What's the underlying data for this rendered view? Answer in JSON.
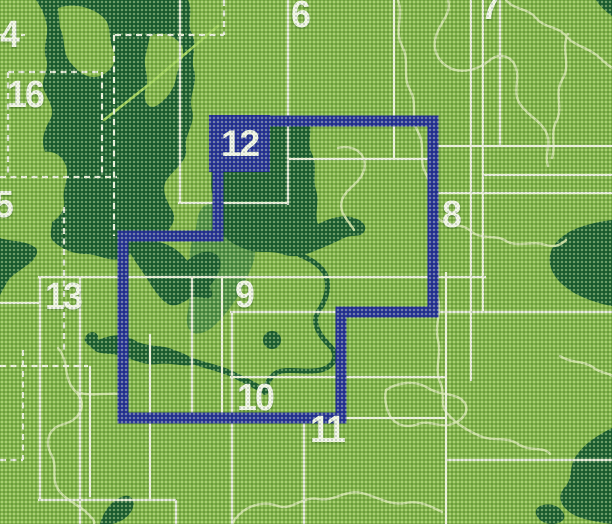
{
  "meta": {
    "description": "Scanned printed index map of a map-sheet series; numbered coverage rectangles over a green relief map, sheet 12 highlighted in blue",
    "width": 612,
    "height": 524
  },
  "colors": {
    "base_green": "#7fb347",
    "dark_green": "#1b5f31",
    "medium_green": "#4f9044",
    "boundary_pale": "#cfe2a8",
    "grid_white": "#edf1e3",
    "route_green": "#9ed058",
    "highlight_blue": "#25309b",
    "label_white": "#f4f7ee"
  },
  "highlight": {
    "sheet": "12",
    "label": "12"
  },
  "sheet_labels": [
    {
      "id": "4",
      "label": "4",
      "x": 0,
      "y": 16
    },
    {
      "id": "16",
      "label": "16",
      "x": 7,
      "y": 76
    },
    {
      "id": "5",
      "label": "5",
      "x": -6,
      "y": 186
    },
    {
      "id": "13",
      "label": "13",
      "x": 45,
      "y": 278
    },
    {
      "id": "6",
      "label": "6",
      "x": 291,
      "y": -4
    },
    {
      "id": "7",
      "label": "7",
      "x": 481,
      "y": -12
    },
    {
      "id": "8",
      "label": "8",
      "x": 442,
      "y": 196
    },
    {
      "id": "9",
      "label": "9",
      "x": 235,
      "y": 276
    },
    {
      "id": "10",
      "label": "10",
      "x": 237,
      "y": 379
    },
    {
      "id": "11",
      "label": "11",
      "x": 310,
      "y": 411
    }
  ]
}
